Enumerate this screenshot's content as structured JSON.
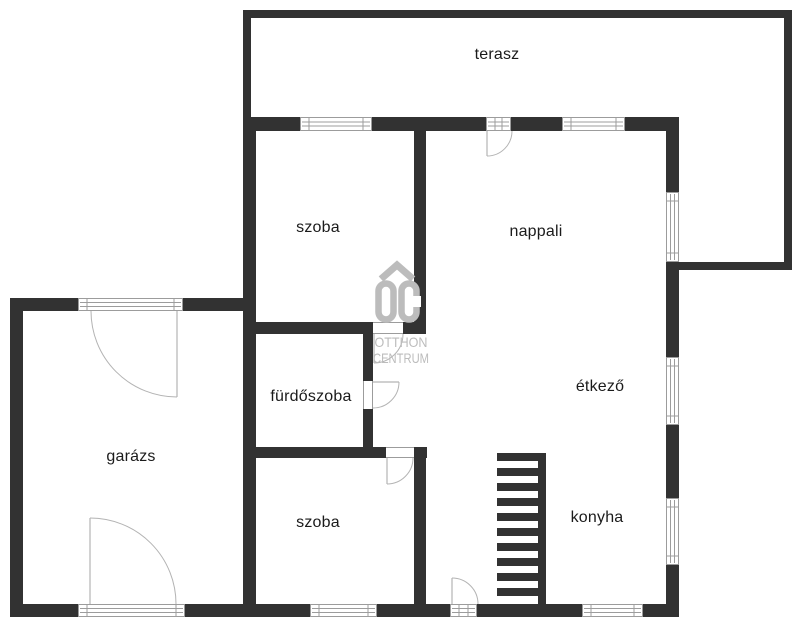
{
  "watermark": {
    "logo_letters": "OC",
    "line1": "OTTHON",
    "line2": "CENTRUM"
  },
  "colors": {
    "wall": "#323232",
    "frame": "#9c9c9c",
    "arc": "#b3b3b3",
    "label": "#1b1b1b",
    "watermark": "#bcbcbc",
    "background": "#ffffff"
  },
  "rooms": [
    {
      "id": "terasz",
      "label": "terasz",
      "x": 497,
      "y": 59
    },
    {
      "id": "szoba-1",
      "label": "szoba",
      "x": 318,
      "y": 232
    },
    {
      "id": "nappali",
      "label": "nappali",
      "x": 536,
      "y": 236
    },
    {
      "id": "furdoszoba",
      "label": "fürdőszoba",
      "x": 311,
      "y": 401
    },
    {
      "id": "garazs",
      "label": "garázs",
      "x": 131,
      "y": 461
    },
    {
      "id": "etkezo",
      "label": "étkező",
      "x": 600,
      "y": 391
    },
    {
      "id": "szoba-2",
      "label": "szoba",
      "x": 318,
      "y": 527
    },
    {
      "id": "konyha",
      "label": "konyha",
      "x": 597,
      "y": 522
    }
  ],
  "geometry": {
    "walls": [
      {
        "name": "terrace-wall-top",
        "x": 243,
        "y": 10,
        "w": 549,
        "h": 8
      },
      {
        "name": "terrace-wall-left",
        "x": 243,
        "y": 18,
        "w": 8,
        "h": 99
      },
      {
        "name": "terrace-wall-right",
        "x": 784,
        "y": 18,
        "w": 8,
        "h": 252
      },
      {
        "name": "terrace-wall-bottom-right",
        "x": 679,
        "y": 262,
        "w": 105,
        "h": 8
      },
      {
        "name": "house-wall-top",
        "x": 243,
        "y": 117,
        "w": 57,
        "h": 14
      },
      {
        "name": "house-wall-top",
        "x": 372,
        "y": 117,
        "w": 114,
        "h": 14
      },
      {
        "name": "house-wall-top",
        "x": 511,
        "y": 117,
        "w": 51,
        "h": 14
      },
      {
        "name": "house-wall-top",
        "x": 625,
        "y": 117,
        "w": 54,
        "h": 14
      },
      {
        "name": "house-wall-left",
        "x": 243,
        "y": 117,
        "w": 13,
        "h": 500
      },
      {
        "name": "house-wall-right",
        "x": 666,
        "y": 131,
        "w": 13,
        "h": 61
      },
      {
        "name": "house-wall-right",
        "x": 666,
        "y": 262,
        "w": 13,
        "h": 95
      },
      {
        "name": "house-wall-right",
        "x": 666,
        "y": 425,
        "w": 13,
        "h": 73
      },
      {
        "name": "house-wall-right",
        "x": 666,
        "y": 565,
        "w": 13,
        "h": 52
      },
      {
        "name": "house-wall-bottom",
        "x": 10,
        "y": 604,
        "w": 68,
        "h": 13
      },
      {
        "name": "house-wall-bottom",
        "x": 185,
        "y": 604,
        "w": 125,
        "h": 13
      },
      {
        "name": "house-wall-bottom",
        "x": 377,
        "y": 604,
        "w": 73,
        "h": 13
      },
      {
        "name": "house-wall-bottom",
        "x": 477,
        "y": 604,
        "w": 105,
        "h": 13
      },
      {
        "name": "house-wall-bottom",
        "x": 643,
        "y": 604,
        "w": 36,
        "h": 13
      },
      {
        "name": "garage-wall-left",
        "x": 10,
        "y": 298,
        "w": 13,
        "h": 319
      },
      {
        "name": "garage-wall-top",
        "x": 10,
        "y": 298,
        "w": 68,
        "h": 13
      },
      {
        "name": "garage-wall-top",
        "x": 183,
        "y": 298,
        "w": 60,
        "h": 13
      },
      {
        "name": "interior-wall-bedroom-living",
        "x": 414,
        "y": 117,
        "w": 12,
        "h": 217
      },
      {
        "name": "interior-wall-bath-top",
        "x": 256,
        "y": 322,
        "w": 117,
        "h": 12
      },
      {
        "name": "interior-wall-bath-top",
        "x": 403,
        "y": 322,
        "w": 23,
        "h": 12
      },
      {
        "name": "interior-wall-bath-right",
        "x": 363,
        "y": 334,
        "w": 10,
        "h": 47
      },
      {
        "name": "interior-wall-bath-right",
        "x": 363,
        "y": 409,
        "w": 10,
        "h": 49
      },
      {
        "name": "interior-wall-bath-bottom",
        "x": 256,
        "y": 447,
        "w": 130,
        "h": 11
      },
      {
        "name": "interior-wall-bath-bottom",
        "x": 414,
        "y": 447,
        "w": 13,
        "h": 11
      },
      {
        "name": "interior-wall-bedroom2-right",
        "x": 414,
        "y": 458,
        "w": 12,
        "h": 146
      }
    ],
    "windows": [
      {
        "name": "window-bedroom1-top",
        "x": 300,
        "y": 117,
        "w": 72,
        "h": 14,
        "o": "h"
      },
      {
        "name": "terrace-door-glazing",
        "x": 486,
        "y": 117,
        "w": 25,
        "h": 14,
        "o": "h"
      },
      {
        "name": "window-living-top",
        "x": 562,
        "y": 117,
        "w": 63,
        "h": 14,
        "o": "h"
      },
      {
        "name": "window-living-right",
        "x": 666,
        "y": 192,
        "w": 13,
        "h": 70,
        "o": "v"
      },
      {
        "name": "window-dining-right",
        "x": 666,
        "y": 357,
        "w": 13,
        "h": 68,
        "o": "v"
      },
      {
        "name": "window-kitchen-right",
        "x": 666,
        "y": 498,
        "w": 13,
        "h": 67,
        "o": "v"
      },
      {
        "name": "garage-door-top",
        "x": 78,
        "y": 298,
        "w": 105,
        "h": 13,
        "o": "h"
      },
      {
        "name": "garage-door-bottom",
        "x": 78,
        "y": 604,
        "w": 107,
        "h": 13,
        "o": "h"
      },
      {
        "name": "window-bedroom2-bottom",
        "x": 310,
        "y": 604,
        "w": 67,
        "h": 13,
        "o": "h"
      },
      {
        "name": "entry-door-glazing",
        "x": 450,
        "y": 604,
        "w": 27,
        "h": 13,
        "o": "h"
      },
      {
        "name": "window-kitchen-bottom",
        "x": 582,
        "y": 604,
        "w": 61,
        "h": 13,
        "o": "h"
      }
    ],
    "door_gaps": [
      {
        "name": "door-opening-bedroom1",
        "x": 373,
        "y": 322,
        "w": 30,
        "h": 12,
        "o": "h"
      },
      {
        "name": "door-opening-bathroom",
        "x": 363,
        "y": 381,
        "w": 10,
        "h": 28,
        "o": "v"
      },
      {
        "name": "door-opening-bedroom2",
        "x": 386,
        "y": 447,
        "w": 28,
        "h": 11,
        "o": "h"
      }
    ],
    "door_arcs": [
      {
        "name": "terrace-door-swing",
        "leaf": [
          487,
          131,
          487,
          156
        ],
        "path": "M 512 131 A 25 25 0 0 1 487 156"
      },
      {
        "name": "bedroom1-door-swing",
        "leaf": [
          374,
          334,
          374,
          363
        ],
        "path": "M 403 334 A 29 29 0 0 1 374 363"
      },
      {
        "name": "bathroom-door-swing",
        "leaf": [
          373,
          382,
          399,
          382
        ],
        "path": "M 399 382 A 26 26 0 0 1 373 408"
      },
      {
        "name": "bedroom2-door-swing",
        "leaf": [
          387,
          458,
          387,
          484
        ],
        "path": "M 413 458 A 26 26 0 0 1 387 484"
      },
      {
        "name": "entry-door-swing",
        "leaf": [
          452,
          578,
          452,
          604
        ],
        "path": "M 452 578 A 26 26 0 0 1 478 604"
      },
      {
        "name": "garage-top-door-swing",
        "leaf": [
          177,
          311,
          177,
          397
        ],
        "path": "M 91 311 A 86 86 0 0 0 177 397"
      },
      {
        "name": "garage-bottom-door-swing",
        "leaf": [
          90,
          518,
          90,
          604
        ],
        "path": "M 90 518 A 86 86 0 0 1 176 604"
      }
    ],
    "stairs": {
      "stringer": {
        "x": 538,
        "y": 453,
        "w": 8,
        "h": 151
      },
      "tread_x": 497,
      "tread_w": 41,
      "first_tread_w": 49,
      "tread_h": 8,
      "tread_ys": [
        453,
        468,
        483,
        498,
        513,
        528,
        543,
        558,
        573,
        588
      ]
    }
  }
}
